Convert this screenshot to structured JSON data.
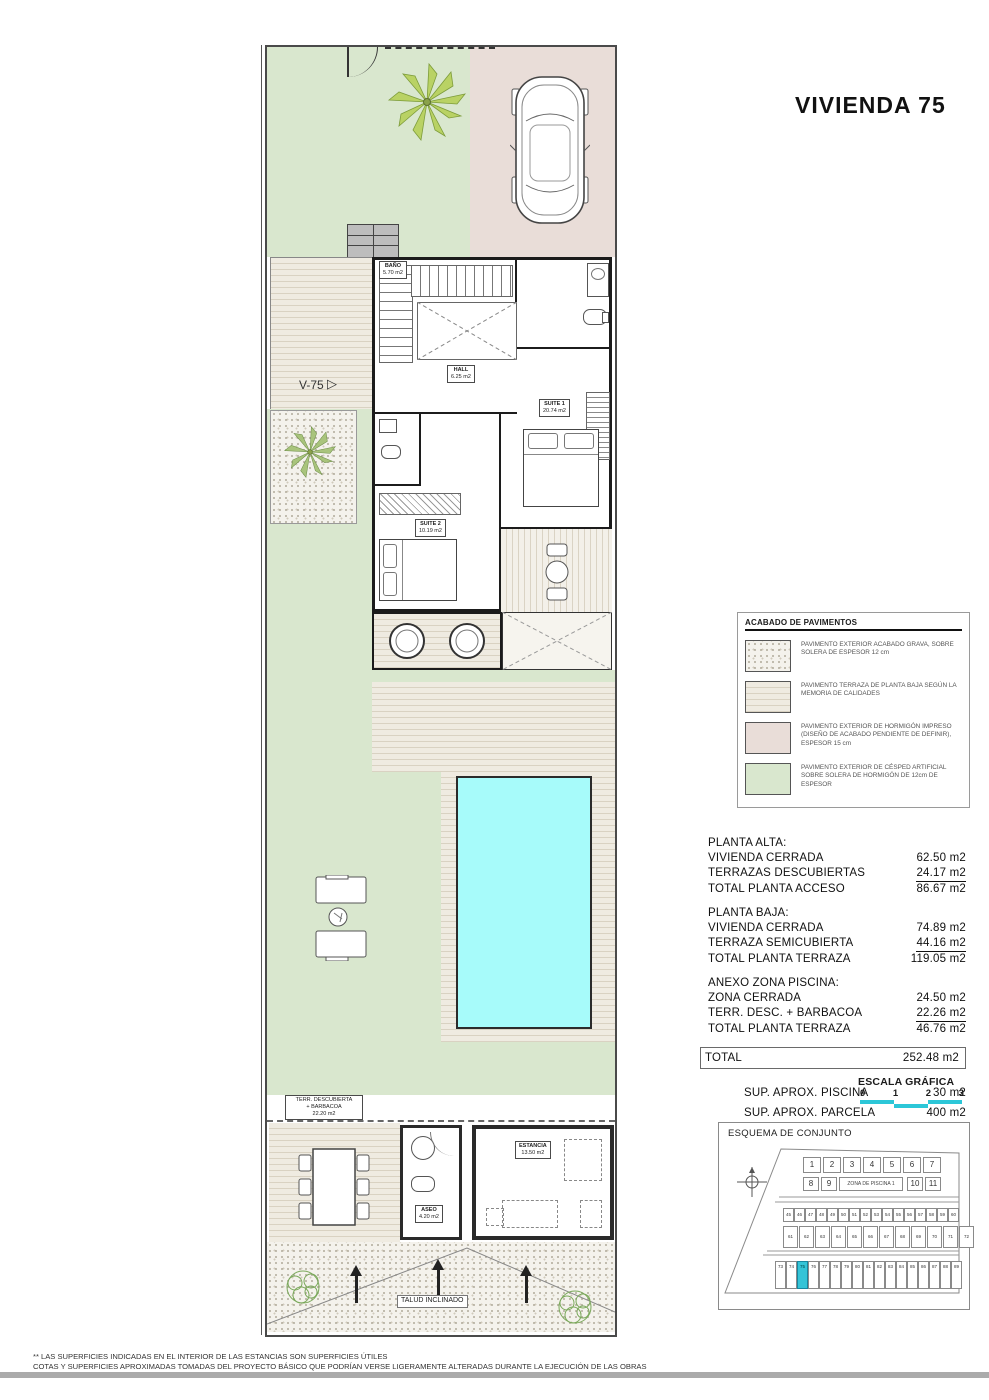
{
  "title": "VIVIENDA 75",
  "plan": {
    "terrace_label": "V-75",
    "rooms": {
      "bano": {
        "name": "BAÑO",
        "area": "5.70 m2"
      },
      "hall": {
        "name": "HALL",
        "area": "6.25 m2"
      },
      "suite1": {
        "name": "SUITE 1",
        "area": "20.74 m2"
      },
      "suite2": {
        "name": "SUITE 2",
        "area": "10.19 m2"
      },
      "terr_barbacoa": {
        "line1": "TERR. DESCUBIERTA",
        "line2": "+ BARBACOA",
        "area": "22.20 m2"
      },
      "aseo": {
        "name": "ASEO",
        "area": "4.20 m2"
      },
      "estancia": {
        "name": "ESTANCIA",
        "area": "13.50 m2"
      }
    },
    "talud_label": "TALUD INCLINADO"
  },
  "legend": {
    "title": "ACABADO DE PAVIMENTOS",
    "items": [
      {
        "text": "PAVIMENTO EXTERIOR ACABADO GRAVA, SOBRE SOLERA DE ESPESOR 12 cm"
      },
      {
        "text": "PAVIMENTO TERRAZA DE PLANTA BAJA SEGÚN LA MEMORIA DE CALIDADES"
      },
      {
        "text": "PAVIMENTO EXTERIOR DE HORMIGÓN IMPRESO (DISEÑO DE ACABADO PENDIENTE DE DEFINIR), ESPESOR 15 cm"
      },
      {
        "text": "PAVIMENTO EXTERIOR DE CÉSPED ARTIFICIAL SOBRE SOLERA DE HORMIGÓN DE 12cm DE ESPESOR"
      }
    ]
  },
  "areas": {
    "sections": [
      {
        "header": "PLANTA ALTA:",
        "rows": [
          {
            "l": "VIVIENDA CERRADA",
            "v": "62.50 m2"
          },
          {
            "l": "TERRAZAS DESCUBIERTAS",
            "v": "24.17 m2"
          },
          {
            "l": "TOTAL PLANTA ACCESO",
            "v": "86.67 m2"
          }
        ]
      },
      {
        "header": "PLANTA BAJA:",
        "rows": [
          {
            "l": "VIVIENDA CERRADA",
            "v": "74.89 m2"
          },
          {
            "l": "TERRAZA SEMICUBIERTA",
            "v": "44.16 m2"
          },
          {
            "l": "TOTAL PLANTA TERRAZA",
            "v": "119.05 m2"
          }
        ]
      },
      {
        "header": "ANEXO ZONA PISCINA:",
        "rows": [
          {
            "l": "ZONA CERRADA",
            "v": "24.50 m2"
          },
          {
            "l": "TERR. DESC. + BARBACOA",
            "v": "22.26 m2"
          },
          {
            "l": "TOTAL PLANTA TERRAZA",
            "v": "46.76 m2"
          }
        ]
      }
    ],
    "total_label": "TOTAL",
    "total_value": "252.48 m2",
    "extras": [
      {
        "l": "SUP.  APROX. PISCINA",
        "v": "30 m2"
      },
      {
        "l": "SUP.  APROX. PARCELA",
        "v": "400 m2"
      }
    ]
  },
  "escala": {
    "title": "ESCALA GRÁFICA",
    "ticks": [
      "0",
      "1",
      "2",
      "3"
    ]
  },
  "esquema": {
    "title": "ESQUEMA DE CONJUNTO",
    "pool_label": "ZONA DE PISCINA 1",
    "row1": [
      "1",
      "2",
      "3",
      "4",
      "5",
      "6",
      "7"
    ],
    "row2a": [
      "8",
      "9"
    ],
    "row2b": [
      "10",
      "11"
    ],
    "row3": [
      "45",
      "46",
      "47",
      "48",
      "49",
      "50",
      "51",
      "52",
      "53",
      "54",
      "55",
      "56",
      "57",
      "58",
      "59",
      "60"
    ],
    "row4": [
      "61",
      "62",
      "63",
      "64",
      "65",
      "66",
      "67",
      "68",
      "69",
      "70",
      "71",
      "72"
    ],
    "row5": [
      "73",
      "74",
      "75",
      "76",
      "77",
      "78",
      "79",
      "80",
      "81",
      "82",
      "83",
      "84",
      "85",
      "86",
      "87",
      "88",
      "89"
    ],
    "highlight_unit": "75"
  },
  "footer": {
    "line1": "** LAS SUPERFICIES INDICADAS EN EL INTERIOR DE LAS ESTANCIAS SON SUPERFICIES ÚTILES",
    "line2": "COTAS Y SUPERFICIES APROXIMADAS TOMADAS DEL PROYECTO BÁSICO QUE PODRÍAN VERSE LIGERAMENTE ALTERADAS DURANTE LA EJECUCIÓN DE LAS OBRAS"
  },
  "colors": {
    "grass": "#d9e7ce",
    "concrete": "#e9ddd8",
    "pool": "#a7fbfa",
    "accent_cyan": "#2cc7d8",
    "highlight": "#35c4d7"
  }
}
